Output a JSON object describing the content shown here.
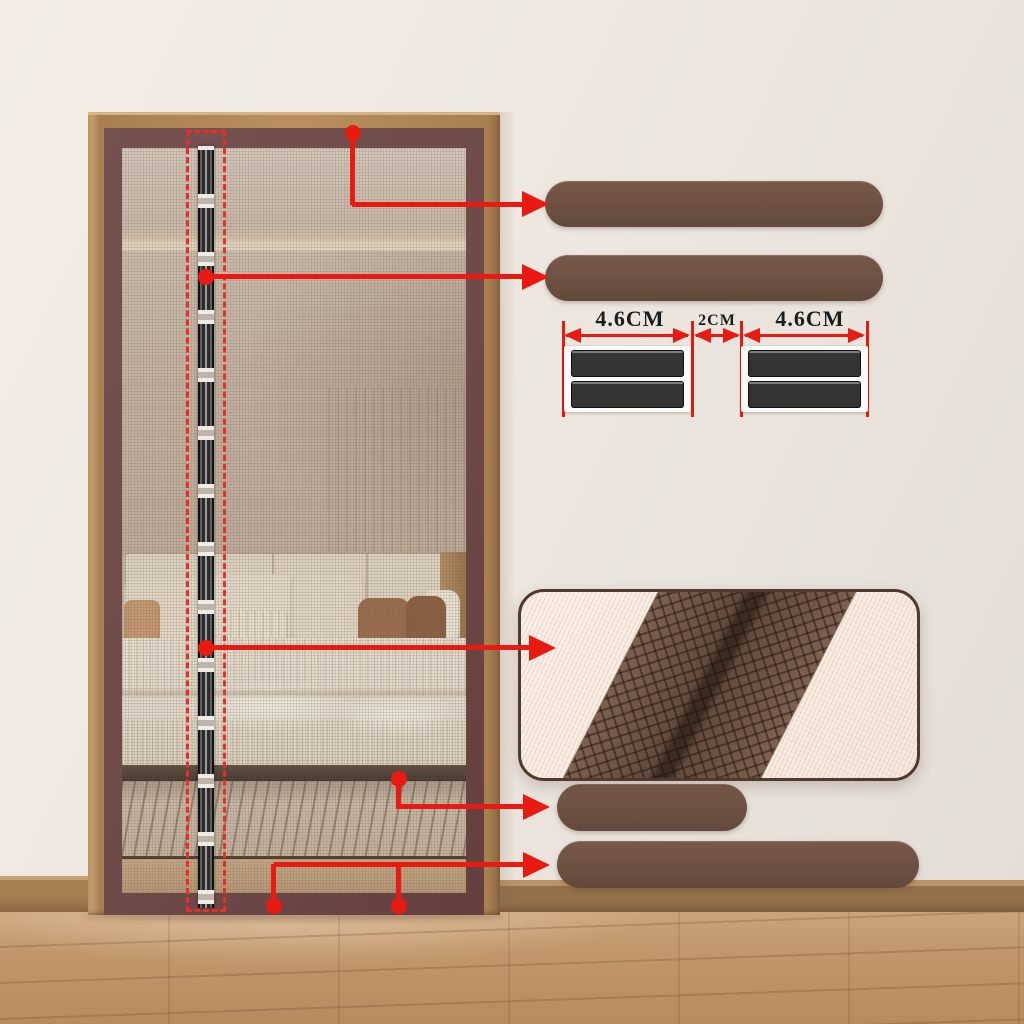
{
  "annotations": {
    "dimension_labels": {
      "left": "4.6CM",
      "center": "2CM",
      "right": "4.6CM"
    }
  },
  "colors": {
    "callout_red": "#e81a12",
    "strip_bar_brown": "#6e5244",
    "screen_frame_maroon": "#6e4a48",
    "door_wood": "#b98f60",
    "adhesive_tape_dark": "#343434",
    "detail_mesh_cream": "#f6ebdf",
    "detail_strip_brown": "#6d5344",
    "wall": "#ece6df",
    "floor_wood": "#c1976b"
  },
  "icons": {
    "callout_arrow": "solid right-pointing triangle",
    "dimension_arrow": "double-headed horizontal arrow",
    "callout_origin_dot": "filled red circle"
  }
}
